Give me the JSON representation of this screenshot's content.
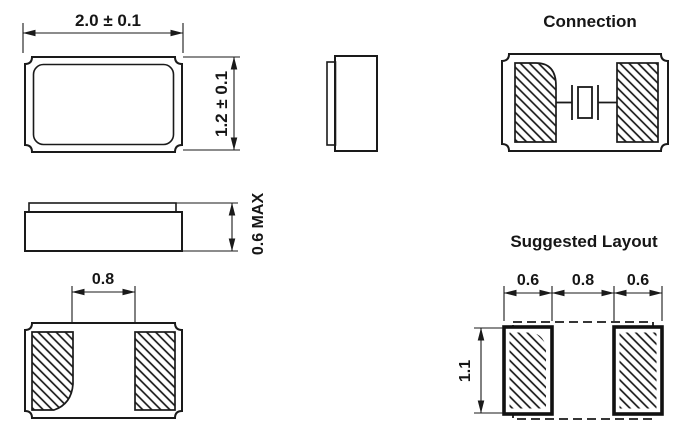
{
  "front": {
    "width_dim": "2.0 ± 0.1",
    "height_dim": "1.2 ± 0.1"
  },
  "side": {
    "height_dim": "0.6 MAX"
  },
  "bottom": {
    "pad_gap_dim": "0.8"
  },
  "connection": {
    "title": "Connection"
  },
  "layout": {
    "title": "Suggested Layout",
    "left_pad_dim": "0.6",
    "gap_dim": "0.8",
    "right_pad_dim": "0.6",
    "height_dim": "1.1"
  },
  "colors": {
    "line": "#1a1a1a",
    "background": "#ffffff"
  }
}
